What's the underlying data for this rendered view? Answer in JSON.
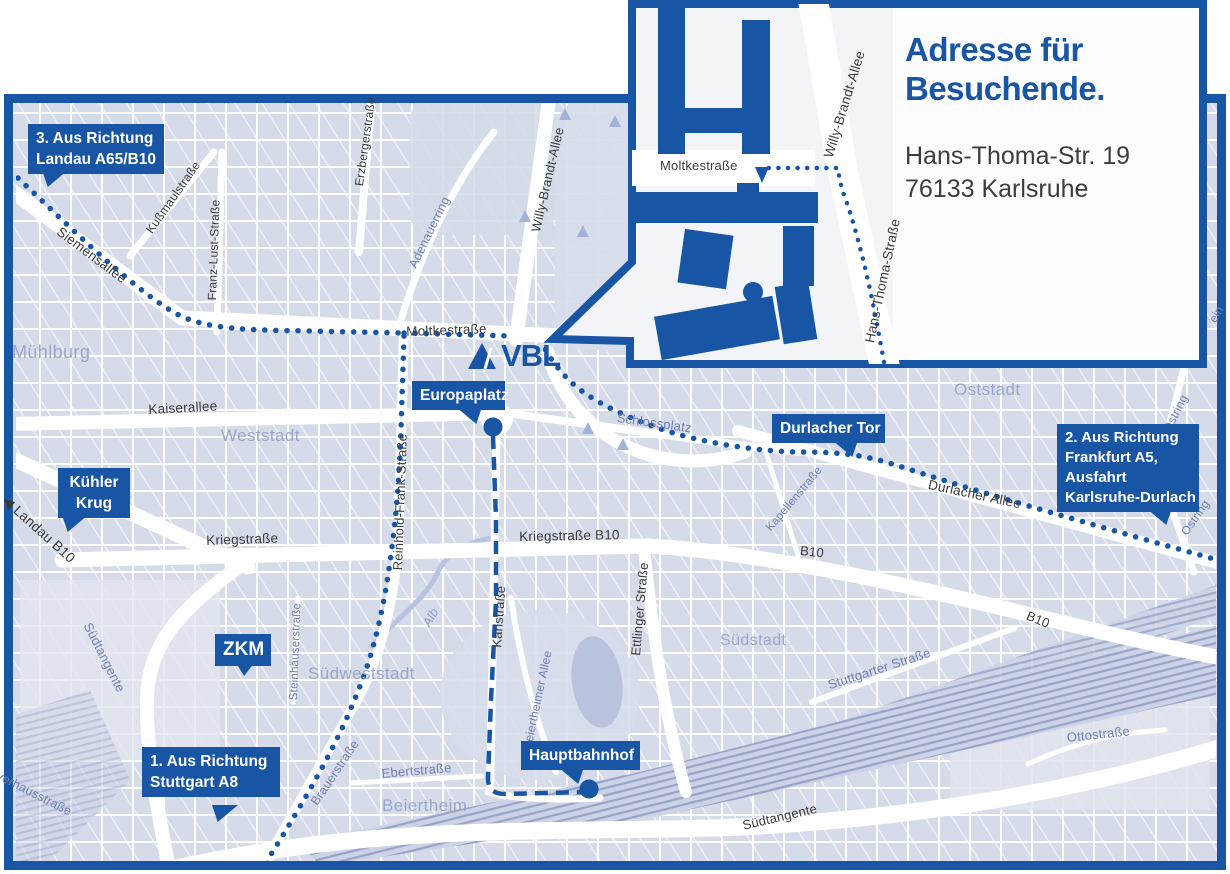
{
  "inset": {
    "title_line1": "Adresse für",
    "title_line2": "Besuchende.",
    "address_line1": "Hans-Thoma-Str. 19",
    "address_line2": "76133 Karlsruhe"
  },
  "logo": {
    "text": "VBL"
  },
  "colors": {
    "primary": "#1856a5",
    "map_block": "#d6dbea",
    "street_white": "#ffffff",
    "area_label": "#9ba7c8",
    "minor_street_label": "#6e80b2",
    "dark_street_label": "#3b3b3b",
    "railway_hatch": "#97a4c9",
    "inset_background": "#f3f4f8",
    "address_text": "#3d3d3d"
  },
  "callouts": [
    {
      "id": "landau",
      "lines": [
        "3. Aus Richtung",
        "Landau A65/B10"
      ],
      "x": 28,
      "y": 124,
      "w": 136,
      "align": "left",
      "tail": {
        "x": 42,
        "y": 170,
        "dir": "dl"
      }
    },
    {
      "id": "kuehler-krug",
      "lines": [
        "Kühler",
        "Krug"
      ],
      "x": 58,
      "y": 468,
      "w": 72,
      "align": "center",
      "tail": {
        "x": 62,
        "y": 515,
        "dir": "dl"
      }
    },
    {
      "id": "zkm",
      "lines": [
        "ZKM"
      ],
      "x": 215,
      "y": 634,
      "w": 56,
      "align": "center",
      "fs": 19,
      "lh": 24,
      "tail": {
        "x": 236,
        "y": 663,
        "dir": "d"
      }
    },
    {
      "id": "europaplatz",
      "lines": [
        "Europaplatz"
      ],
      "x": 412,
      "y": 381,
      "w": 93,
      "align": "center",
      "tail": {
        "x": 456,
        "y": 407,
        "dir": "dr"
      },
      "dot": {
        "x": 493,
        "y": 427
      }
    },
    {
      "id": "durlacher-tor",
      "lines": [
        "Durlacher Tor"
      ],
      "x": 772,
      "y": 414,
      "w": 113,
      "align": "center",
      "tail": {
        "x": 832,
        "y": 440,
        "dir": "dr"
      }
    },
    {
      "id": "hauptbahnhof",
      "lines": [
        "Hauptbahnhof"
      ],
      "x": 521,
      "y": 741,
      "w": 119,
      "align": "center",
      "tail": {
        "x": 558,
        "y": 767,
        "dir": "dr"
      },
      "dot": {
        "x": 589,
        "y": 789
      }
    },
    {
      "id": "stuttgart",
      "lines": [
        "1. Aus Richtung",
        "Stuttgart A8"
      ],
      "x": 142,
      "y": 747,
      "w": 138,
      "align": "left",
      "tail": {
        "x": 212,
        "y": 805,
        "dir": "dl"
      }
    },
    {
      "id": "frankfurt",
      "lines": [
        "2. Aus Richtung",
        "Frankfurt A5,",
        "Ausfahrt",
        "Karlsruhe-Durlach"
      ],
      "x": 1057,
      "y": 424,
      "w": 142,
      "align": "left",
      "fs": 15,
      "lh": 20,
      "tail": {
        "x": 1146,
        "y": 508,
        "dir": "dr"
      }
    }
  ],
  "street_labels": [
    {
      "t": "Siemensallee",
      "x": 63,
      "y": 224,
      "r": 37,
      "s": 13.5,
      "c": "dark"
    },
    {
      "t": "Kußmaulstraße",
      "x": 143,
      "y": 228,
      "r": -55,
      "s": 12,
      "c": "dark"
    },
    {
      "t": "Franz-Lust-Straße",
      "x": 205,
      "y": 300,
      "r": -88,
      "s": 12,
      "c": "dark"
    },
    {
      "t": "Erzbergerstraße",
      "x": 352,
      "y": 185,
      "r": -82,
      "s": 12,
      "c": "dark"
    },
    {
      "t": "Willy-Brandt-Allee",
      "x": 528,
      "y": 230,
      "r": -77,
      "s": 13,
      "c": "dark"
    },
    {
      "t": "Moltkestraße",
      "x": 406,
      "y": 324,
      "r": -2,
      "s": 13.5,
      "c": "dark"
    },
    {
      "t": "Kaiserallee",
      "x": 148,
      "y": 402,
      "r": -3,
      "s": 13.5,
      "c": "dark"
    },
    {
      "t": "Reinhold-Frank-Straße",
      "x": 390,
      "y": 570,
      "r": -88,
      "s": 13,
      "c": "dark"
    },
    {
      "t": "Kriegstraße",
      "x": 206,
      "y": 533,
      "r": -2,
      "s": 13.5,
      "c": "dark"
    },
    {
      "t": "Kriegstraße B10",
      "x": 519,
      "y": 529,
      "r": -1,
      "s": 13.5,
      "c": "dark"
    },
    {
      "t": "Karlstraße",
      "x": 489,
      "y": 647,
      "r": -86,
      "s": 13,
      "c": "dark"
    },
    {
      "t": "Ettlinger Straße",
      "x": 628,
      "y": 655,
      "r": -85,
      "s": 13,
      "c": "dark"
    },
    {
      "t": "Durlacher Allee",
      "x": 930,
      "y": 477,
      "r": 12,
      "s": 13.5,
      "c": "dark"
    },
    {
      "t": "B10",
      "x": 801,
      "y": 543,
      "r": 6,
      "s": 13,
      "c": "dark"
    },
    {
      "t": "B10",
      "x": 1030,
      "y": 608,
      "r": 22,
      "s": 13,
      "c": "dark"
    },
    {
      "t": "◀ Landau B10",
      "x": 10,
      "y": 492,
      "r": 42,
      "s": 14,
      "c": "dark"
    },
    {
      "t": "Südtangente",
      "x": 741,
      "y": 818,
      "r": -13,
      "s": 13,
      "c": "dark"
    },
    {
      "t": "Adenauerring",
      "x": 406,
      "y": 264,
      "r": -64,
      "s": 12.5,
      "c": "blue"
    },
    {
      "t": "Schlossplatz",
      "x": 618,
      "y": 410,
      "r": 8,
      "s": 13,
      "c": "blue"
    },
    {
      "t": "Kapellenstraße",
      "x": 764,
      "y": 526,
      "r": -50,
      "s": 11.5,
      "c": "blue"
    },
    {
      "t": "Ostring",
      "x": 1160,
      "y": 428,
      "r": -63,
      "s": 12,
      "c": "blue"
    },
    {
      "t": "Ostring",
      "x": 1178,
      "y": 530,
      "r": -55,
      "s": 12,
      "c": "blue"
    },
    {
      "t": "ein",
      "x": 1206,
      "y": 318,
      "r": -60,
      "s": 12,
      "c": "blue"
    },
    {
      "t": "Steinhäuserstraße",
      "x": 288,
      "y": 700,
      "r": -88,
      "s": 11.5,
      "c": "blue"
    },
    {
      "t": "Beiertheimer Allee",
      "x": 520,
      "y": 748,
      "r": -78,
      "s": 12,
      "c": "blue"
    },
    {
      "t": "Brauerstraße",
      "x": 308,
      "y": 800,
      "r": -56,
      "s": 12.5,
      "c": "blue"
    },
    {
      "t": "Ebertstraße",
      "x": 381,
      "y": 766,
      "r": -5,
      "s": 13,
      "c": "blue"
    },
    {
      "t": "Stuttgarter Straße",
      "x": 826,
      "y": 678,
      "r": -18,
      "s": 13,
      "c": "blue"
    },
    {
      "t": "Ottostraße",
      "x": 1066,
      "y": 730,
      "r": -6,
      "s": 13,
      "c": "blue"
    },
    {
      "t": "Südtangente",
      "x": 94,
      "y": 620,
      "r": 63,
      "s": 13,
      "c": "blue"
    },
    {
      "t": "Pulverhausstraße",
      "x": -16,
      "y": 760,
      "r": 27,
      "s": 12.5,
      "c": "blue"
    },
    {
      "t": "Alb",
      "x": 420,
      "y": 622,
      "r": -60,
      "s": 12.5,
      "c": "faint"
    },
    {
      "t": "Moltkestraße",
      "x": 660,
      "y": 158,
      "r": 0,
      "s": 13,
      "c": "dark"
    },
    {
      "t": "Willy-Brandt-Allee",
      "x": 821,
      "y": 155,
      "r": -73,
      "s": 13.5,
      "c": "dark"
    },
    {
      "t": "Hans-Thoma-Straße",
      "x": 862,
      "y": 341,
      "r": -78,
      "s": 13.5,
      "c": "dark"
    }
  ],
  "area_labels": [
    {
      "t": "Mühlburg",
      "x": 12,
      "y": 342,
      "s": 18
    },
    {
      "t": "Weststadt",
      "x": 221,
      "y": 426,
      "s": 17
    },
    {
      "t": "Südweststadt",
      "x": 308,
      "y": 664,
      "s": 17
    },
    {
      "t": "Oststadt",
      "x": 954,
      "y": 380,
      "s": 17
    },
    {
      "t": "Südstadt",
      "x": 720,
      "y": 632,
      "s": 16
    },
    {
      "t": "Beiertheim",
      "x": 382,
      "y": 796,
      "s": 17
    }
  ]
}
